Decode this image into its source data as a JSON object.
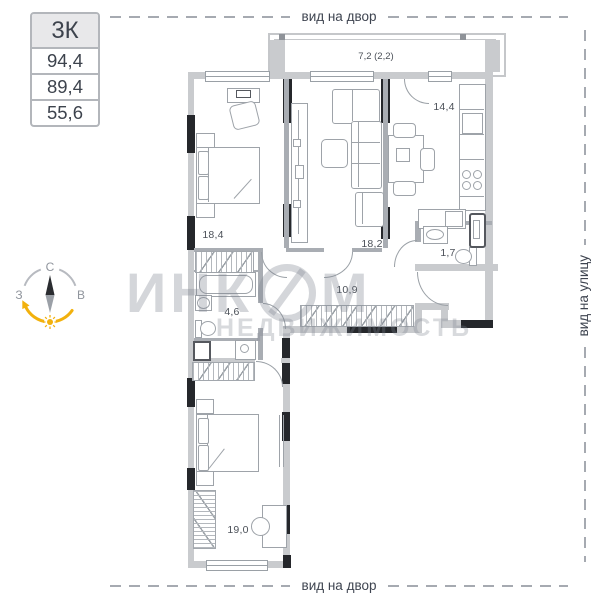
{
  "info_box": {
    "type_label": "3К",
    "areas": [
      "94,4",
      "89,4",
      "55,6"
    ]
  },
  "view_labels": {
    "top": "вид на двор",
    "bottom": "вид на двор",
    "right": "вид на улицу"
  },
  "compass": {
    "north": "С",
    "west": "З",
    "east": "В"
  },
  "balcony": {
    "area": "7,2 (2,2)"
  },
  "rooms": [
    {
      "id": "bedroom-1",
      "area": "18,4"
    },
    {
      "id": "living-room",
      "area": "18,2"
    },
    {
      "id": "kitchen",
      "area": "14,4"
    },
    {
      "id": "hallway",
      "area": "10,9"
    },
    {
      "id": "bathroom",
      "area": "4,6"
    },
    {
      "id": "wc",
      "area": "1,7"
    },
    {
      "id": "bedroom-2",
      "area": "19,0"
    }
  ],
  "watermark": {
    "brand_prefix": "ИНК",
    "brand_suffix": "М",
    "subtitle": "НЕДВИЖИМОСТЬ"
  },
  "colors": {
    "wall_gray": "#c9cbce",
    "structure_black": "#25272b",
    "accent_yellow": "#f2b10d",
    "text_dark": "#3f4450",
    "dash_gray": "#a6aab1"
  }
}
